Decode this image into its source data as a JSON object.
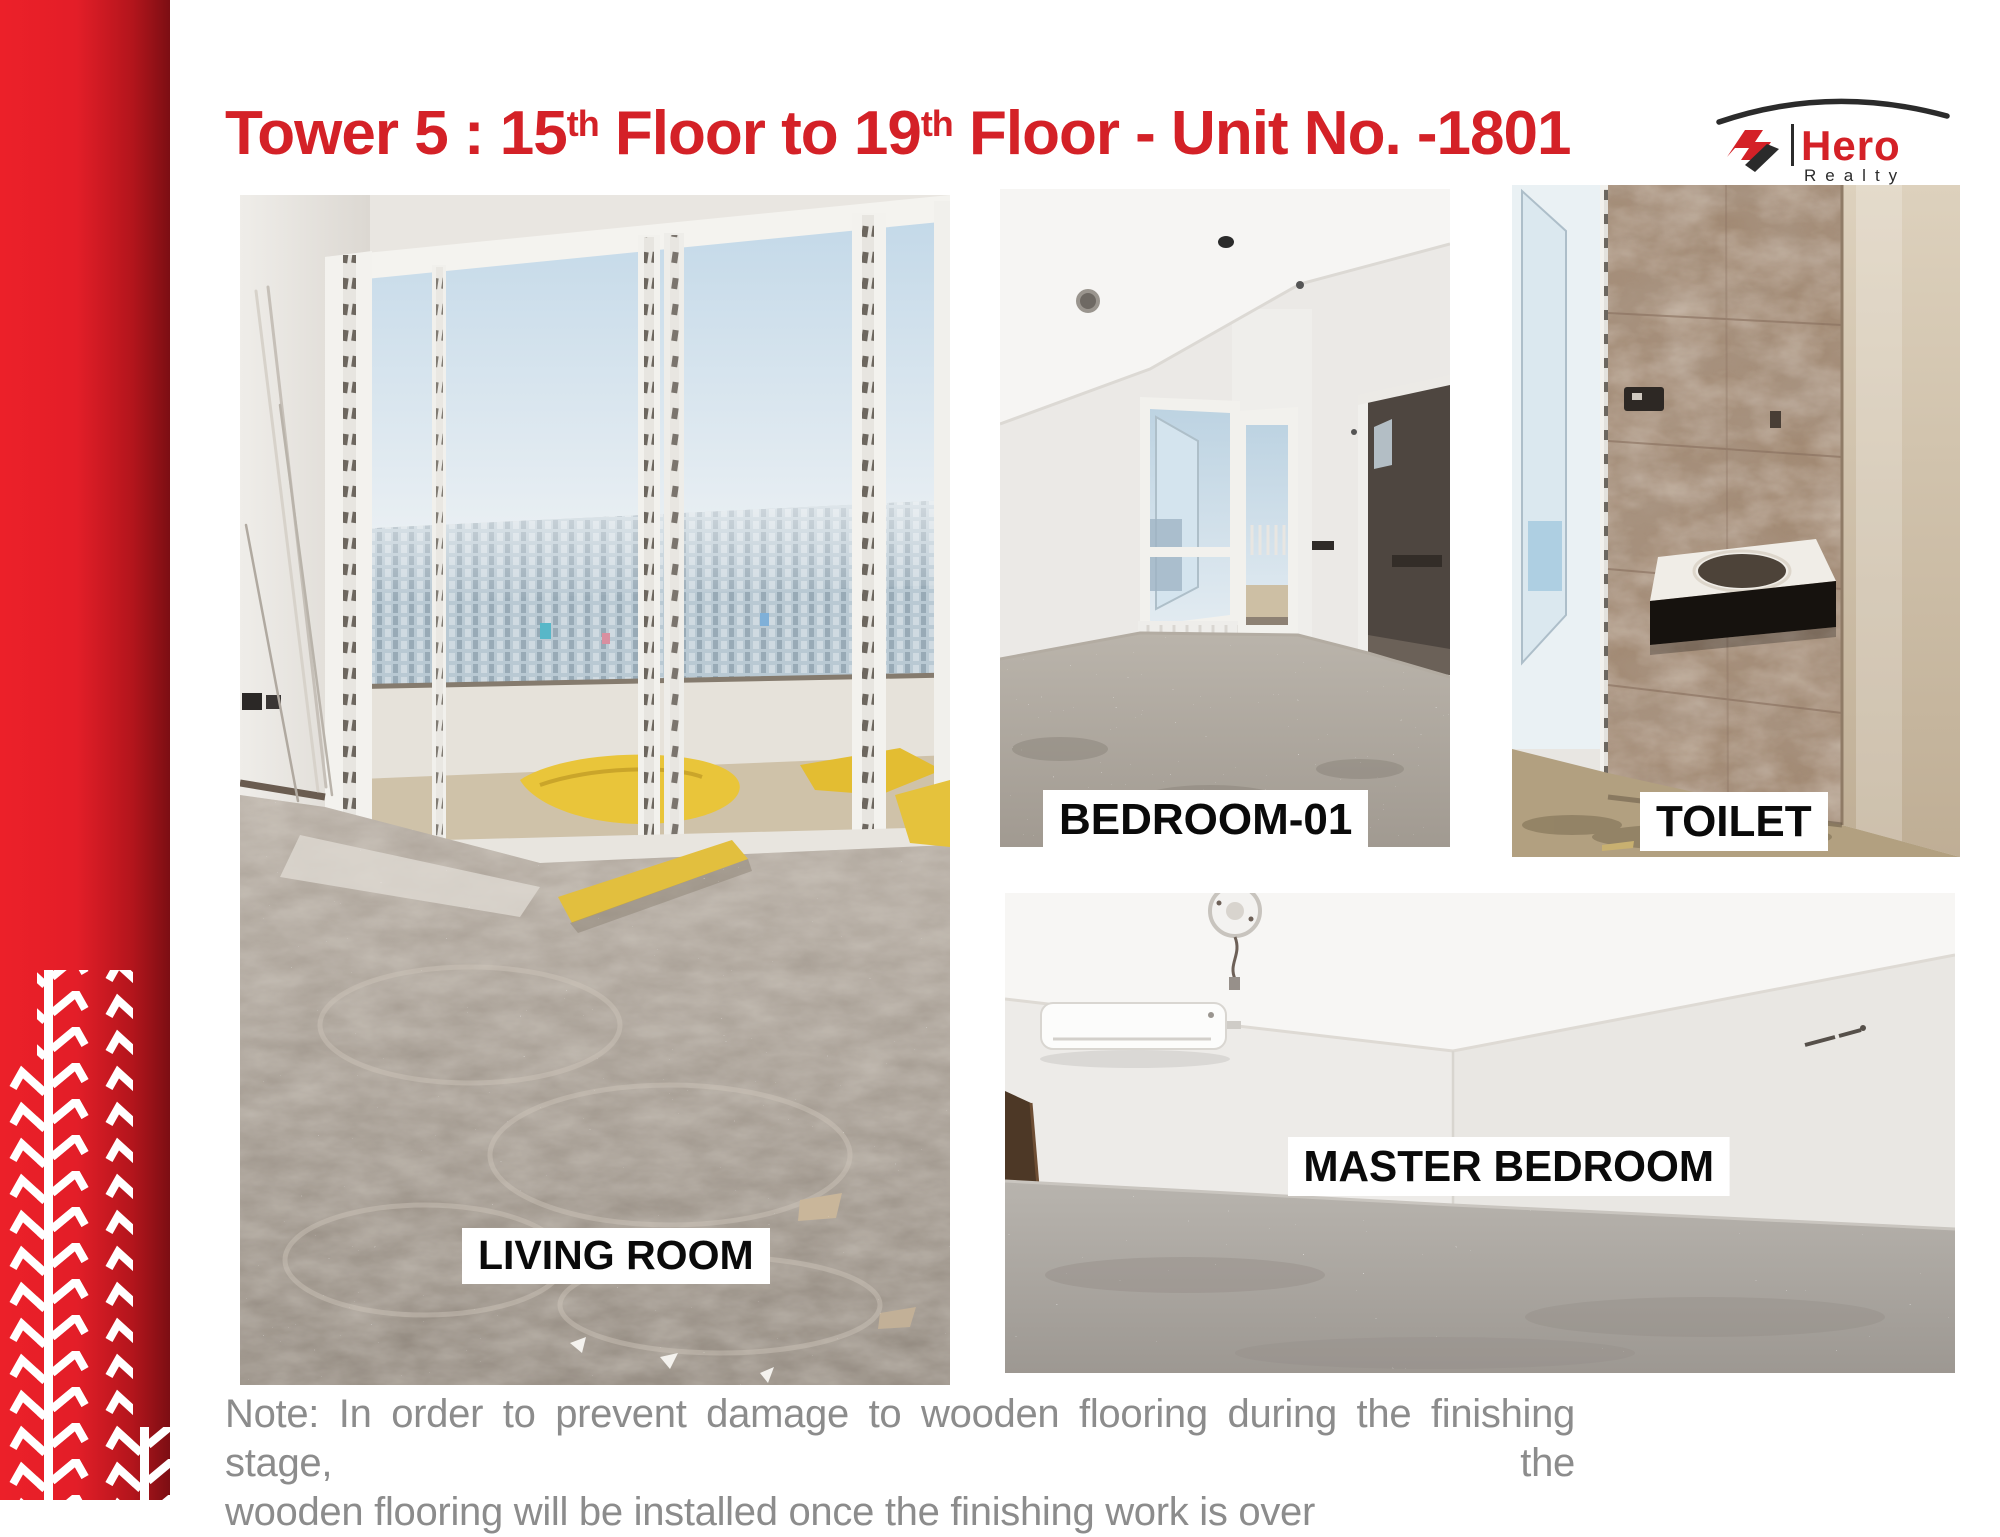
{
  "slide": {
    "title": {
      "t1": "Tower 5 : 15",
      "s1": "th",
      "t2": " Floor to 19",
      "s2": "th",
      "t3": " Floor - Unit No. -1801"
    },
    "note_line1": "Note: In order to prevent damage to wooden flooring during the finishing stage, the",
    "note_line2": "wooden flooring will be installed once the finishing work is over"
  },
  "logo": {
    "brand": "Hero",
    "sub": "Realty"
  },
  "photos": {
    "living_room": {
      "label": "LIVING ROOM"
    },
    "bedroom_01": {
      "label": "BEDROOM-01"
    },
    "toilet": {
      "label": "TOILET"
    },
    "master_bedroom": {
      "label": "MASTER BEDROOM"
    }
  },
  "colors": {
    "accent_red": "#d42127",
    "bar_red_light": "#ec2029",
    "bar_red_dark": "#7c0e13",
    "note_gray": "#8c8c8c",
    "label_bg": "#ffffff",
    "label_text": "#0a0a0a"
  }
}
